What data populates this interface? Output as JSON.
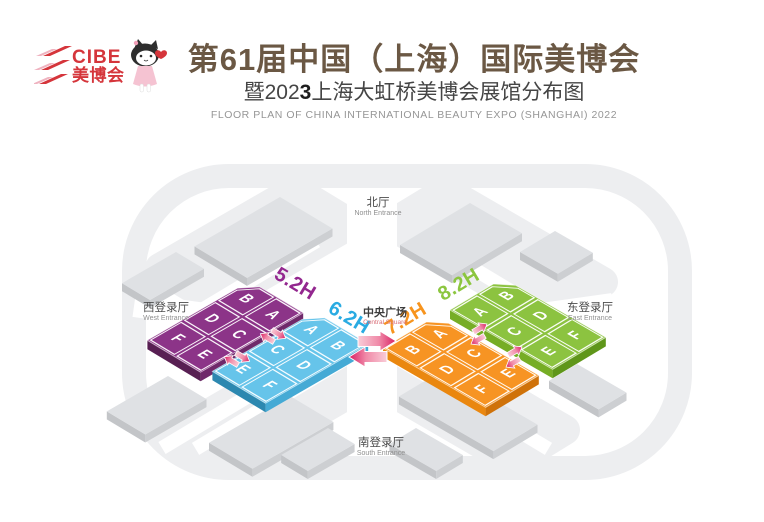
{
  "header": {
    "logo": {
      "brand": "CIBE",
      "brand_cn": "美博会"
    },
    "title": "第61届中国（上海）国际美博会",
    "subtitle_prefix": "暨202",
    "subtitle_year_digit": "3",
    "subtitle_suffix": "上海大虹桥美博会展馆分布图",
    "subtitle_en": "FLOOR PLAN OF CHINA INTERNATIONAL BEAUTY EXPO (SHANGHAI) 2022"
  },
  "map": {
    "central_square": {
      "zh": "中央广场",
      "en": "Central Square"
    },
    "entrances": {
      "north": {
        "zh": "北厅",
        "en": "North Entrance"
      },
      "south": {
        "zh": "南登录厅",
        "en": "South Entrance"
      },
      "west": {
        "zh": "西登录厅",
        "en": "West Entrance"
      },
      "east": {
        "zh": "东登录厅",
        "en": "East Entrance"
      }
    },
    "halls": [
      {
        "label": "5.2H",
        "color": "#8c3488",
        "label_color": "#93278f",
        "sections": [
          "B",
          "A",
          "D",
          "C",
          "F",
          "E"
        ]
      },
      {
        "label": "6.2H",
        "color": "#66c4ea",
        "label_color": "#29abe2",
        "sections": [
          "A",
          "B",
          "C",
          "D",
          "E",
          "F"
        ]
      },
      {
        "label": "7.2H",
        "color": "#f79423",
        "label_color": "#f7941d",
        "sections": [
          "B",
          "A",
          "D",
          "C",
          "F",
          "E"
        ]
      },
      {
        "label": "8.2H",
        "color": "#8cc340",
        "label_color": "#8cc63f",
        "sections": [
          "A",
          "B",
          "C",
          "D",
          "E",
          "F"
        ]
      }
    ],
    "accent_arrow_color": "#d81f63"
  }
}
